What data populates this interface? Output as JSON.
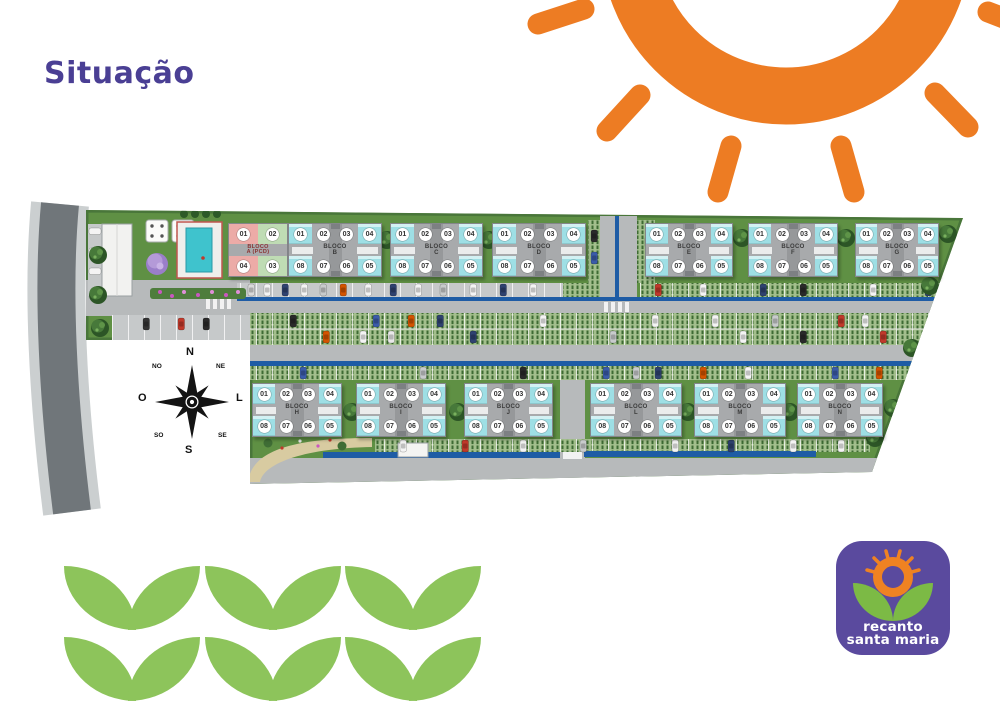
{
  "title": "Situação",
  "compass": {
    "n": "N",
    "ne": "NE",
    "l": "L",
    "se": "SE",
    "s": "S",
    "so": "SO",
    "o": "O",
    "no": "NO"
  },
  "logo": {
    "line1": "recanto",
    "line2": "santa maria"
  },
  "blocks": {
    "top": [
      {
        "id": "A",
        "label": "BLOCO",
        "sub": "A (PCD)",
        "pcd": true,
        "units_top": [
          "01",
          "02"
        ],
        "units_bottom": [
          "04",
          "03"
        ]
      },
      {
        "id": "B",
        "label": "BLOCO",
        "sub": "B",
        "units_top": [
          "01",
          "02",
          "03",
          "04"
        ],
        "units_bottom": [
          "08",
          "07",
          "06",
          "05"
        ]
      },
      {
        "id": "C",
        "label": "BLOCO",
        "sub": "C",
        "units_top": [
          "01",
          "02",
          "03",
          "04"
        ],
        "units_bottom": [
          "08",
          "07",
          "06",
          "05"
        ]
      },
      {
        "id": "D",
        "label": "BLOCO",
        "sub": "D",
        "units_top": [
          "01",
          "02",
          "03",
          "04"
        ],
        "units_bottom": [
          "08",
          "07",
          "06",
          "05"
        ]
      },
      {
        "id": "E",
        "label": "BLOCO",
        "sub": "E",
        "units_top": [
          "01",
          "02",
          "03",
          "04"
        ],
        "units_bottom": [
          "08",
          "07",
          "06",
          "05"
        ]
      },
      {
        "id": "F",
        "label": "BLOCO",
        "sub": "F",
        "units_top": [
          "01",
          "02",
          "03",
          "04"
        ],
        "units_bottom": [
          "08",
          "07",
          "06",
          "05"
        ]
      },
      {
        "id": "G",
        "label": "BLOCO",
        "sub": "G",
        "units_top": [
          "01",
          "02",
          "03",
          "04"
        ],
        "units_bottom": [
          "08",
          "07",
          "06",
          "05"
        ]
      }
    ],
    "bottom": [
      {
        "id": "H",
        "label": "BLOCO",
        "sub": "H",
        "units_top": [
          "01",
          "02",
          "03",
          "04"
        ],
        "units_bottom": [
          "08",
          "07",
          "06",
          "05"
        ]
      },
      {
        "id": "I",
        "label": "BLOCO",
        "sub": "I",
        "units_top": [
          "01",
          "02",
          "03",
          "04"
        ],
        "units_bottom": [
          "08",
          "07",
          "06",
          "05"
        ]
      },
      {
        "id": "J",
        "label": "BLOCO",
        "sub": "J",
        "units_top": [
          "01",
          "02",
          "03",
          "04"
        ],
        "units_bottom": [
          "08",
          "07",
          "06",
          "05"
        ]
      },
      {
        "id": "L",
        "label": "BLOCO",
        "sub": "L",
        "units_top": [
          "01",
          "02",
          "03",
          "04"
        ],
        "units_bottom": [
          "08",
          "07",
          "06",
          "05"
        ]
      },
      {
        "id": "M",
        "label": "BLOCO",
        "sub": "M",
        "units_top": [
          "01",
          "02",
          "03",
          "04"
        ],
        "units_bottom": [
          "08",
          "07",
          "06",
          "05"
        ]
      },
      {
        "id": "N",
        "label": "BLOCO",
        "sub": "N",
        "units_top": [
          "01",
          "02",
          "03",
          "04"
        ],
        "units_bottom": [
          "08",
          "07",
          "06",
          "05"
        ]
      }
    ]
  },
  "colors": {
    "title_purple": "#4a3f94",
    "sun_orange": "#ed7c23",
    "leaf_green": "#8dc45b",
    "logo_bg": "#5a4a9e",
    "logo_leaf": "#7cba45",
    "site_green": "#5f9044",
    "unit_cyan": "#9edfe5",
    "curb_blue": "#1e5ca5",
    "pcd_pink": "#ecaba7",
    "pcd_green": "#bfdcb4"
  }
}
